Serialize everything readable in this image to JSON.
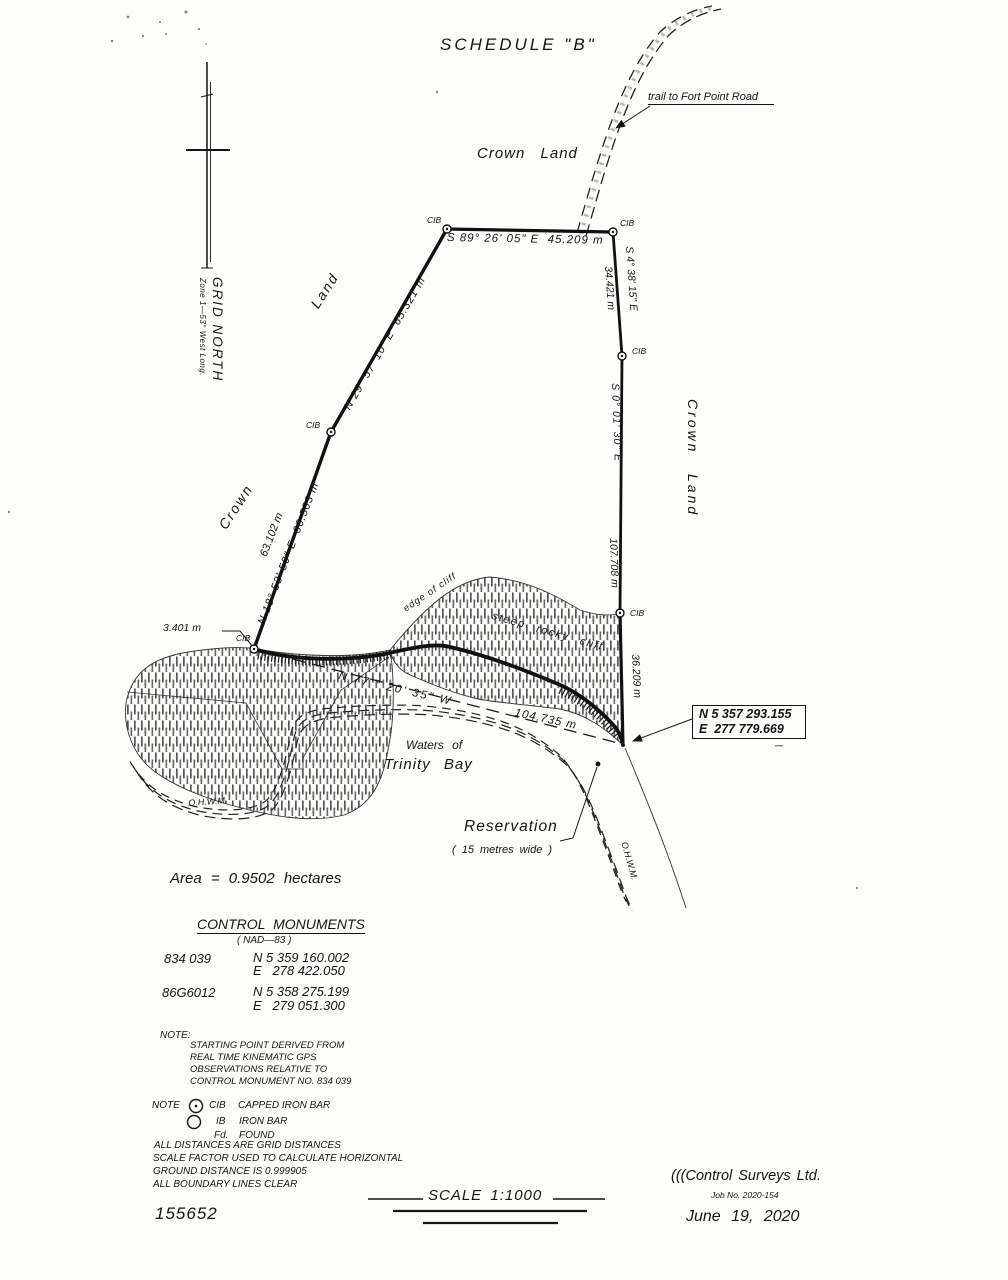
{
  "title": "SCHEDULE \"B\"",
  "map": {
    "trail_label": "trail to Fort Point Road",
    "crown_land_top": "Crown Land",
    "crown_w": "Crown",
    "land_w": "Land",
    "edge_of_cliff": "edge of cliff",
    "steep_rocky_cliff": "steep rocky cliff.",
    "waters_of": "Waters of",
    "trinity_bay": "Trinity Bay",
    "ohwm": "O.H.W.M.",
    "reservation": "Reservation",
    "reservation_width": "( 15 metres wide )",
    "area": "Area = 0.9502 hectares",
    "grid_north": "GRID NORTH",
    "zone": "Zone 1—53° West Long.",
    "cib": "CIB",
    "coord_n": "N 5 357 293.155",
    "coord_e": "E  277 779.669"
  },
  "bearings": {
    "top": "S 89° 26' 05\" E  45.209 m",
    "right_upper_bearing": "S 4° 38' 15\" E",
    "right_upper_dist": "34.421 m",
    "right_bearing": "S 0° 01' 30\" E",
    "right_dist": "107.708 m",
    "right_lower_dist": "36.209 m",
    "nw_bearing": "N 29° 57' 10\" E  65.321 m",
    "sw_bearing": "N 18° 53' 50\" E  66.503 m",
    "sw_dist": "63.102 m",
    "tie_bearing": "N 77 ° 20' 35\" W",
    "tie_dist": "104.735 m",
    "offset_dist": "3.401 m"
  },
  "monuments": {
    "heading": "CONTROL MONUMENTS",
    "datum": "( NAD—83 )",
    "rows": [
      {
        "id": "834 039",
        "n": "N 5 359 160.002",
        "e": "E   278 422.050"
      },
      {
        "id": "86G6012",
        "n": "N 5 358 275.199",
        "e": "E   279 051.300"
      }
    ]
  },
  "notes": {
    "note_label": "NOTE:",
    "note_lines": [
      "STARTING POINT DERIVED FROM",
      "REAL TIME KINEMATIC GPS",
      "OBSERVATIONS RELATIVE TO",
      "CONTROL MONUMENT NO. 834 039"
    ],
    "legend_label": "NOTE",
    "legend": [
      {
        "abbr": "CIB",
        "text": "CAPPED IRON BAR"
      },
      {
        "abbr": "IB",
        "text": "IRON BAR"
      },
      {
        "abbr": "Fd.",
        "text": "FOUND"
      }
    ],
    "extra_lines": [
      "ALL DISTANCES ARE GRID DISTANCES",
      "SCALE FACTOR USED TO CALCULATE HORIZONTAL",
      "GROUND DISTANCE IS 0.999905",
      "ALL BOUNDARY LINES CLEAR"
    ]
  },
  "footer": {
    "plan_no": "155652",
    "scale": "SCALE 1:1000",
    "company": "(((Control Surveys Ltd.",
    "job": "Job No. 2020-154",
    "date": "June 19, 2020"
  }
}
